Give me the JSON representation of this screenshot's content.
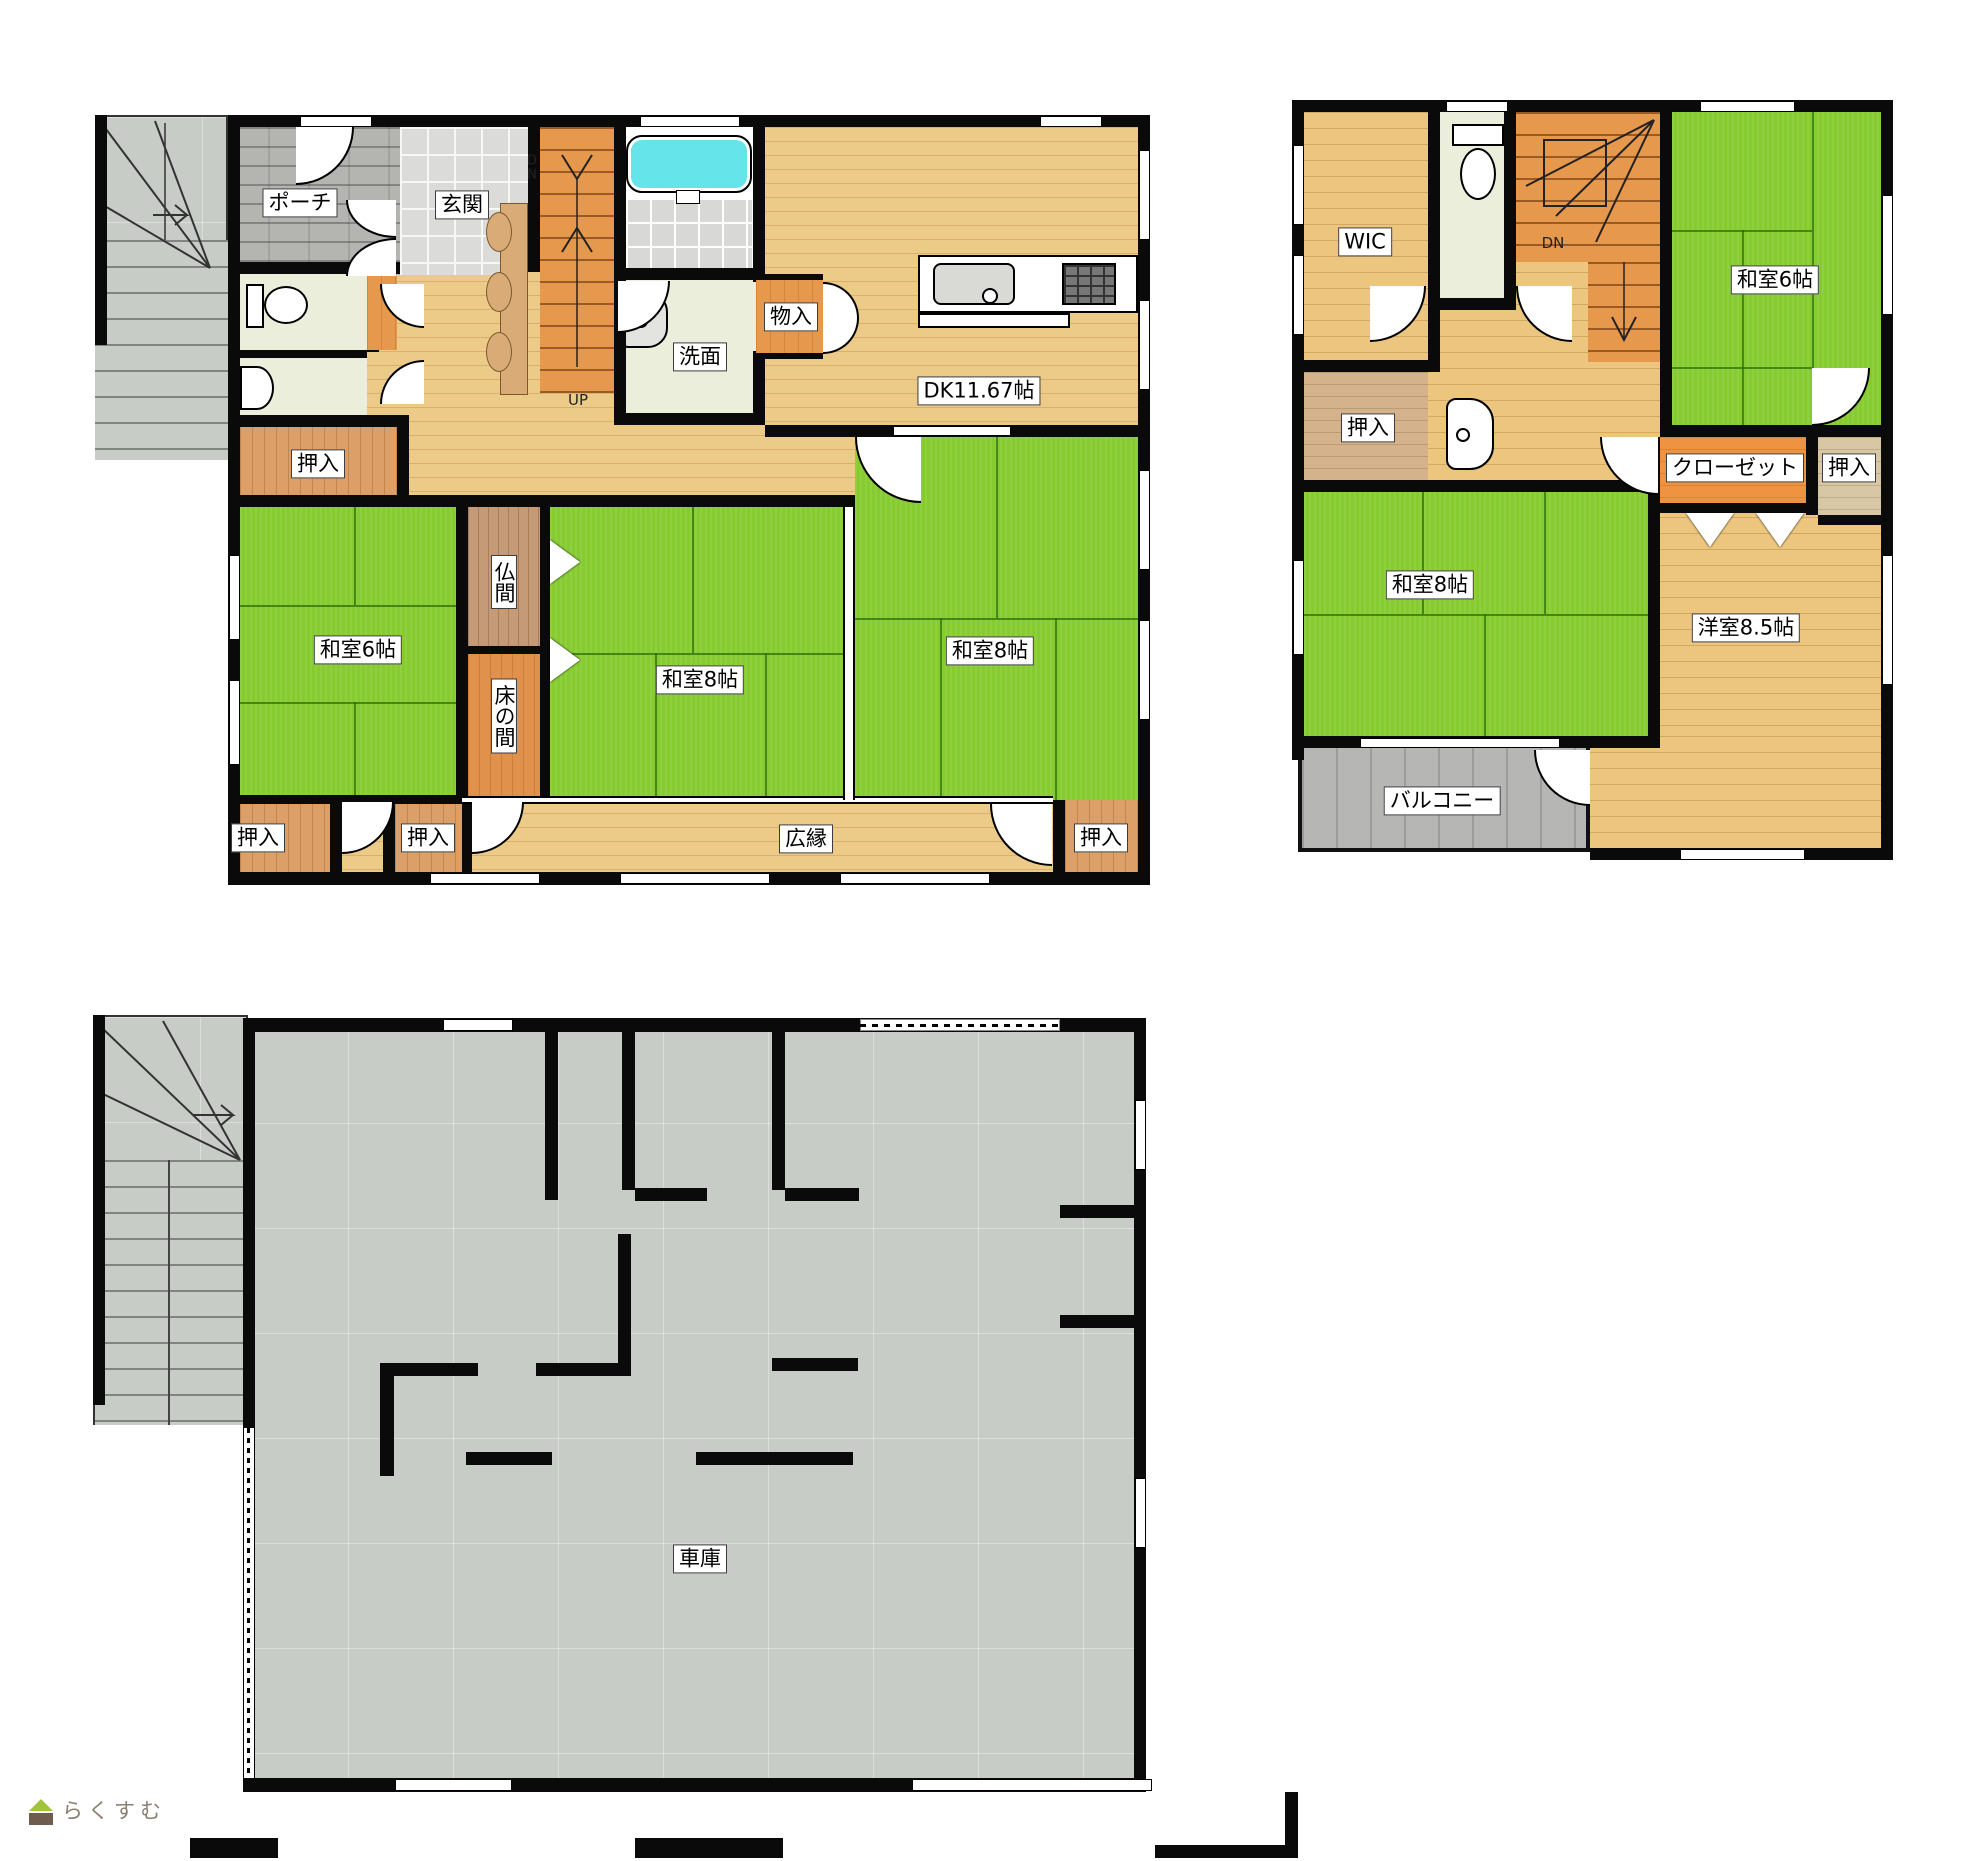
{
  "meta": {
    "title": "間取り図 (floor plan)"
  },
  "colors": {
    "tatami_green": "#86cb30",
    "wood_floor": "#ecc67e",
    "closet_orange": "#e6984d",
    "stair_orange": "#e6984d",
    "concrete_grey": "#c7ccc6",
    "balcony_grey": "#b6b6b4",
    "bathtub_cyan": "#65e5ea",
    "wall_black": "#0a0a0a"
  },
  "floor1": {
    "labels": {
      "porch": "ポーチ",
      "entrance": "玄関",
      "dn_stacked": "D\nN",
      "up": "UP",
      "washroom": "洗面",
      "storage": "物入",
      "dk": "DK11.67帖",
      "closet_top": "押入",
      "washitsu6": "和室6帖",
      "butsuma": "仏間",
      "tokonoma": "床の間",
      "washitsu8_center": "和室8帖",
      "washitsu8_right": "和室8帖",
      "closet_bottom_left": "押入",
      "closet_bottom_mid": "押入",
      "veranda": "広縁",
      "closet_bottom_right": "押入"
    }
  },
  "floor2": {
    "labels": {
      "wic": "WIC",
      "dn": "DN",
      "washitsu6": "和室6帖",
      "closet_left": "押入",
      "washitsu8": "和室8帖",
      "closet": "クローゼット",
      "closet_right": "押入",
      "western_room": "洋室8.5帖",
      "balcony": "バルコニー"
    }
  },
  "garage": {
    "label": "車庫"
  },
  "logo": {
    "text": "らくすむ",
    "icon": "house-icon"
  }
}
